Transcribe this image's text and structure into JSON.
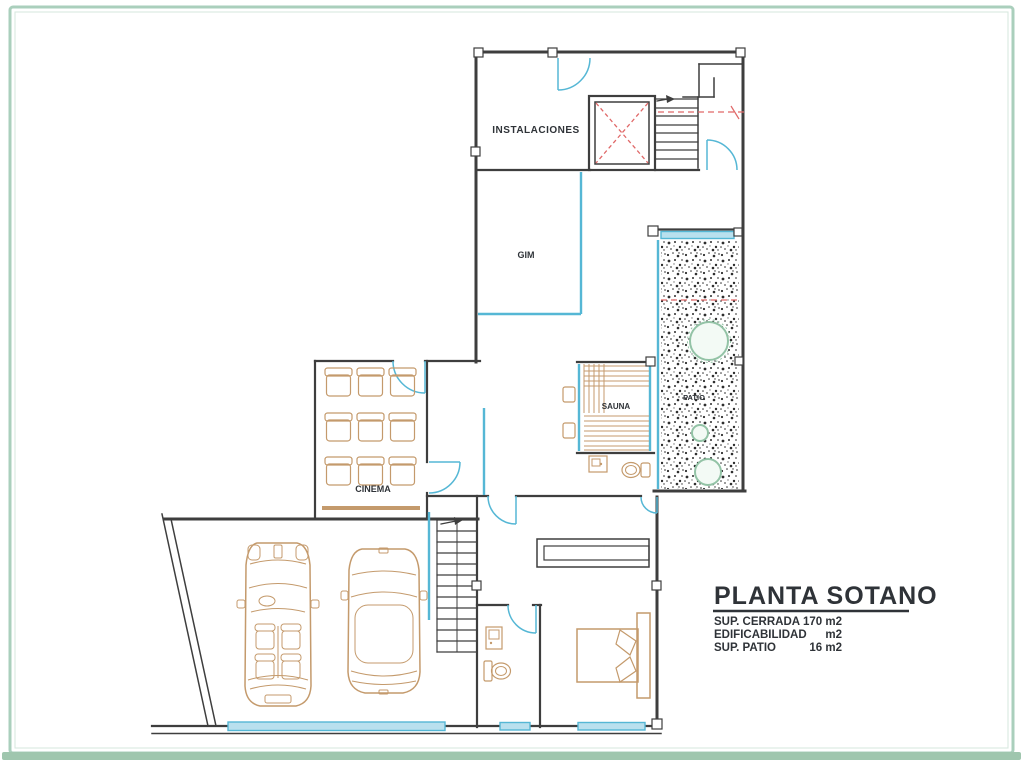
{
  "colors": {
    "wall": "#3e3e3e",
    "glass": "#55b7d5",
    "glass_fill": "#b9e0ee",
    "wood": "#c49a6c",
    "red": "#e06868",
    "tree": "#93c3a6",
    "frame": "#aacfbc",
    "frame_accent": "#9fc6ae"
  },
  "rooms": {
    "instalaciones": "INSTALACIONES",
    "gim": "GIM",
    "sauna": "SAUNA",
    "patio": "PATIO",
    "cinema": "CINEMA"
  },
  "title_block": {
    "title": "PLANTA SOTANO",
    "rows": [
      {
        "label": "SUP. CERRADA",
        "value": "170 m2"
      },
      {
        "label": "EDIFICABILIDAD",
        "value": "m2"
      },
      {
        "label": "SUP. PATIO",
        "value": "16 m2"
      }
    ]
  }
}
